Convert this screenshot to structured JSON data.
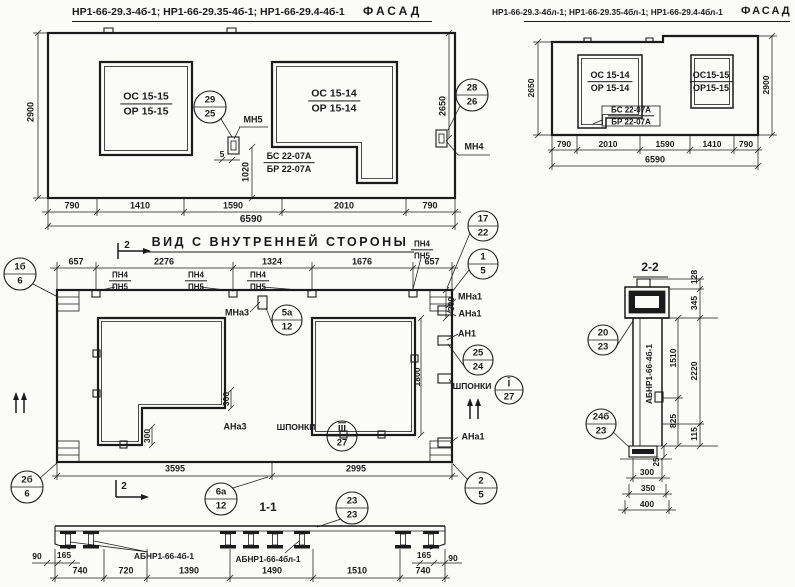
{
  "facade_left": {
    "codes": "НР1-66-29.3-4б-1; НР1-66-29.35-4б-1; НР1-66-29.4-4б-1",
    "view_title": "ФАСАД",
    "win1_top": "ОС 15-15",
    "win1_bot": "ОР 15-15",
    "win2_top": "ОС 15-14",
    "win2_bot": "ОР 15-14",
    "bal_top": "БС 22-07А",
    "bal_bot": "БР 22-07А",
    "mn5": "МН5",
    "mn4": "МН4",
    "c29": "29",
    "c25": "25",
    "c28": "28",
    "c26": "26",
    "d2900": "2900",
    "d2650": "2650",
    "d1020": "1020",
    "d5": "5",
    "db": [
      "790",
      "1410",
      "1590",
      "2010",
      "790"
    ],
    "dtot": "6590"
  },
  "facade_right": {
    "codes": "НР1-66-29.3-4бл-1; НР1-66-29.35-4бл-1; НР1-66-29.4-4бл-1",
    "view_title": "ФАСАД",
    "win1_top": "ОС 15-14",
    "win1_bot": "ОР 15-14",
    "win2_top": "ОС15-15",
    "win2_bot": "ОР15-15",
    "bal_top": "БС 22-07А",
    "bal_bot": "БР 22-07А",
    "d2650": "2650",
    "d2900": "2900",
    "db": [
      "790",
      "2010",
      "1590",
      "1410",
      "790"
    ],
    "dtot": "6590"
  },
  "inner_view": {
    "title": "ВИД С ВНУТРЕННЕЙ СТОРОНЫ",
    "dt": [
      "657",
      "2276",
      "1324",
      "1676",
      "657"
    ],
    "pn4": "ПН4",
    "pn5": "ПН5",
    "c17": "17",
    "c22": "22",
    "c1": "1",
    "c5": "5",
    "mna1": "МНа1",
    "ana1": "АНа1",
    "an1": "АН1",
    "mna3": "МНа3",
    "ana3": "АНа3",
    "c5a": "5а",
    "c12": "12",
    "c25": "25",
    "c24": "24",
    "shponki": "ШПОНКИ",
    "key1": "I",
    "key3": "III",
    "c27": "27",
    "c1b": "1б",
    "c2b": "2б",
    "c6": "6",
    "c6a": "6а",
    "c2": "2",
    "c23": "23",
    "mark2": "2",
    "d300": "300",
    "d1800": "1800",
    "d3595": "3595",
    "d2995": "2995",
    "sec11_title": "1-1"
  },
  "section11": {
    "label_left": "АБНР1-66-4б-1",
    "label_right": "АБНР1-66-4бл-1",
    "dims": [
      "740",
      "720",
      "1390",
      "1490",
      "1510",
      "740"
    ],
    "d90": "90",
    "d165": "165"
  },
  "section22": {
    "title": "2-2",
    "label": "АБНР1-66-4б-1",
    "c20": "20",
    "c23": "23",
    "c24b": "24б",
    "d128": "128",
    "d345": "345",
    "d1510": "1510",
    "d2220": "2220",
    "d825": "825",
    "d115": "115",
    "d25": "25",
    "d300": "300",
    "d350": "350",
    "d400": "400"
  }
}
